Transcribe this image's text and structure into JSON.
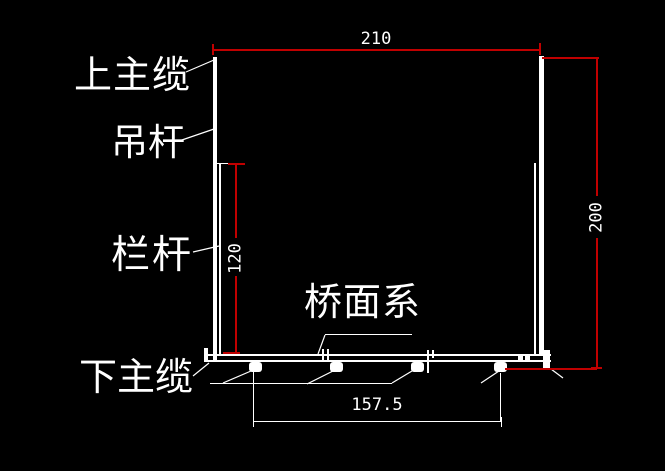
{
  "drawing": {
    "description": "CAD cross-section of a suspension footbridge deck",
    "background_color": "#000000",
    "colors": {
      "w": "#ffffff",
      "r": "#c00000"
    },
    "labels": {
      "upper_main_cable": "上主缆",
      "hanger_rod": "吊杆",
      "railing": "栏杆",
      "lower_main_cable": "下主缆",
      "deck_system": "桥面系"
    },
    "dimensions": {
      "top_width": "210",
      "right_height": "200",
      "railing_height": "120",
      "clamp_spacing": "157.5"
    },
    "shapes": [
      {
        "name": "left-hanger-member",
        "x": 213,
        "y": 57,
        "w": 4,
        "h": 303,
        "c": "w"
      },
      {
        "name": "left-railing-member",
        "x": 219,
        "y": 163,
        "w": 2,
        "h": 193,
        "c": "w"
      },
      {
        "name": "right-railing-member",
        "x": 534,
        "y": 163,
        "w": 2,
        "h": 192,
        "c": "w"
      },
      {
        "name": "right-hanger-member",
        "x": 539,
        "y": 56,
        "w": 5,
        "h": 300,
        "c": "w"
      },
      {
        "name": "deck-top-chord",
        "x": 204,
        "y": 354,
        "w": 347,
        "h": 2,
        "c": "w"
      },
      {
        "name": "deck-bottom-chord",
        "x": 204,
        "y": 360,
        "w": 347,
        "h": 2,
        "c": "w"
      },
      {
        "name": "deck-left-end-post",
        "x": 204,
        "y": 348,
        "w": 4,
        "h": 14,
        "c": "w"
      },
      {
        "name": "deck-right-end-block",
        "x": 543,
        "y": 350,
        "w": 7,
        "h": 18,
        "c": "w"
      },
      {
        "name": "cable-clamp",
        "x": 249,
        "y": 362,
        "w": 13,
        "h": 10,
        "c": "w",
        "r": 3
      },
      {
        "name": "cable-clamp",
        "x": 330,
        "y": 362,
        "w": 13,
        "h": 10,
        "c": "w",
        "r": 3
      },
      {
        "name": "cable-clamp",
        "x": 411,
        "y": 362,
        "w": 13,
        "h": 10,
        "c": "w",
        "r": 3
      },
      {
        "name": "cable-clamp",
        "x": 494,
        "y": 362,
        "w": 13,
        "h": 10,
        "c": "w",
        "r": 3
      },
      {
        "name": "deck-joint-tick",
        "x": 322,
        "y": 349,
        "w": 2,
        "h": 13,
        "c": "w"
      },
      {
        "name": "deck-joint-tick",
        "x": 327,
        "y": 349,
        "w": 2,
        "h": 13,
        "c": "w"
      },
      {
        "name": "deck-joint-tick",
        "x": 427,
        "y": 350,
        "w": 2,
        "h": 23,
        "c": "w"
      },
      {
        "name": "deck-joint-tick",
        "x": 432,
        "y": 350,
        "w": 2,
        "h": 8,
        "c": "w"
      },
      {
        "name": "deck-joint-plate",
        "x": 518,
        "y": 355,
        "w": 5,
        "h": 7,
        "c": "w"
      },
      {
        "name": "deck-joint-plate",
        "x": 525,
        "y": 355,
        "w": 5,
        "h": 7,
        "c": "w"
      },
      {
        "name": "dim-line-210",
        "x": 213,
        "y": 49,
        "w": 328,
        "h": 2,
        "c": "r"
      },
      {
        "name": "dim-tick",
        "x": 212,
        "y": 44,
        "w": 2,
        "h": 11,
        "c": "r"
      },
      {
        "name": "dim-tick",
        "x": 539,
        "y": 43,
        "w": 2,
        "h": 12,
        "c": "r"
      },
      {
        "name": "dim-ext-200-top",
        "x": 542,
        "y": 57,
        "w": 57,
        "h": 2,
        "c": "r"
      },
      {
        "name": "dim-line-200-upper",
        "x": 596,
        "y": 57,
        "w": 2,
        "h": 139,
        "c": "r"
      },
      {
        "name": "dim-line-200-lower",
        "x": 596,
        "y": 238,
        "w": 2,
        "h": 131,
        "c": "r"
      },
      {
        "name": "dim-tick",
        "x": 591,
        "y": 367,
        "w": 11,
        "h": 2,
        "c": "r"
      },
      {
        "name": "dim-ext-200-bottom",
        "x": 505,
        "y": 368,
        "w": 92,
        "h": 2,
        "c": "r"
      },
      {
        "name": "dim-ext-120",
        "x": 217,
        "y": 163,
        "w": 12,
        "h": 1,
        "c": "w"
      },
      {
        "name": "dim-line-120-upper",
        "x": 235,
        "y": 164,
        "w": 2,
        "h": 74,
        "c": "r"
      },
      {
        "name": "dim-line-120-lower",
        "x": 235,
        "y": 276,
        "w": 2,
        "h": 78,
        "c": "r"
      },
      {
        "name": "dim-tick",
        "x": 228,
        "y": 163,
        "w": 17,
        "h": 2,
        "c": "r"
      },
      {
        "name": "dim-tick",
        "x": 223,
        "y": 352,
        "w": 17,
        "h": 2,
        "c": "r"
      },
      {
        "name": "dim-line-157",
        "x": 253,
        "y": 421,
        "w": 249,
        "h": 1,
        "c": "w"
      },
      {
        "name": "dim-tick-white",
        "x": 253,
        "y": 417,
        "w": 1,
        "h": 10,
        "c": "w"
      },
      {
        "name": "dim-tick-white",
        "x": 501,
        "y": 417,
        "w": 1,
        "h": 10,
        "c": "w"
      },
      {
        "name": "dim-ext-157-left",
        "x": 253,
        "y": 372,
        "w": 1,
        "h": 50,
        "c": "w"
      },
      {
        "name": "dim-ext-157-right",
        "x": 500,
        "y": 373,
        "w": 1,
        "h": 49,
        "c": "w"
      },
      {
        "name": "deck-label-underline",
        "x": 325,
        "y": 334,
        "w": 87,
        "h": 1,
        "c": "w"
      },
      {
        "name": "clamp-leader-line",
        "x": 210,
        "y": 383,
        "w": 182,
        "h": 1,
        "c": "w"
      }
    ],
    "leaders": [
      {
        "name": "upper-cable-leader",
        "x1": 186,
        "y1": 72,
        "x2": 214,
        "y2": 60
      },
      {
        "name": "hanger-leader",
        "x1": 179,
        "y1": 141,
        "x2": 214,
        "y2": 129
      },
      {
        "name": "railing-leader",
        "x1": 193,
        "y1": 252,
        "x2": 219,
        "y2": 246
      },
      {
        "name": "lower-cable-leader",
        "x1": 193,
        "y1": 376,
        "x2": 209,
        "y2": 363
      },
      {
        "name": "deck-system-leader",
        "x1": 325,
        "y1": 335,
        "x2": 318,
        "y2": 354
      },
      {
        "name": "clamp-leader",
        "x1": 223,
        "y1": 383,
        "x2": 251,
        "y2": 371
      },
      {
        "name": "clamp-leader",
        "x1": 307,
        "y1": 384,
        "x2": 333,
        "y2": 371
      },
      {
        "name": "clamp-leader",
        "x1": 392,
        "y1": 383,
        "x2": 412,
        "y2": 371
      },
      {
        "name": "clamp-leader",
        "x1": 481,
        "y1": 383,
        "x2": 499,
        "y2": 371
      },
      {
        "name": "deck-end-leader",
        "x1": 551,
        "y1": 369,
        "x2": 563,
        "y2": 378
      }
    ]
  }
}
